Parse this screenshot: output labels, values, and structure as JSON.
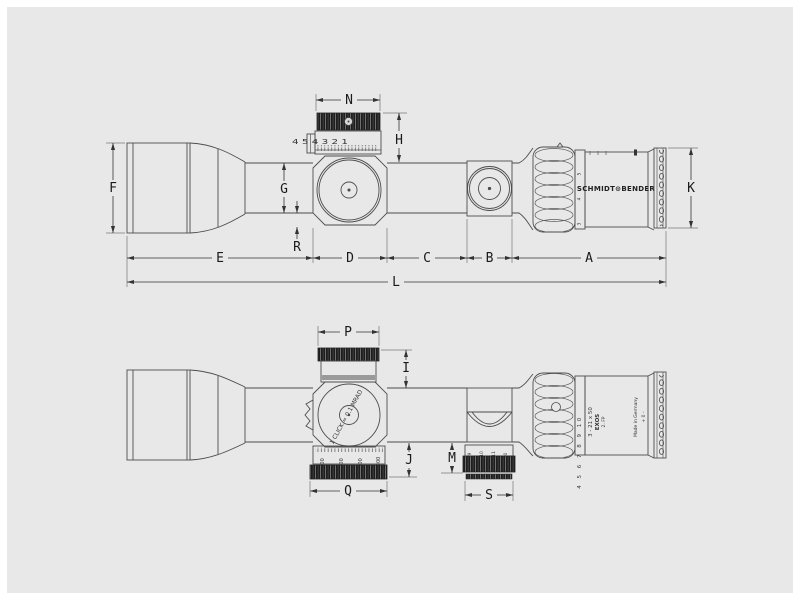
{
  "background_color": "#e8e8e8",
  "line_color": "#4d4d4d",
  "brand_text": "SCHMIDT⊙BENDER",
  "side_view": {
    "dims": {
      "N": "N",
      "H": "H",
      "F": "F",
      "G": "G",
      "R": "R",
      "K": "K",
      "E": "E",
      "D": "D",
      "C": "C",
      "B": "B",
      "A": "A",
      "L": "L"
    },
    "elevation_scale": "4 5 4 3 2 1",
    "zoom_visible": [
      "3",
      "4",
      "5"
    ]
  },
  "plan_view": {
    "dims": {
      "P": "P",
      "I": "I",
      "J": "J",
      "M": "M",
      "Q": "Q",
      "S": "S"
    },
    "click_text": "1 CLICK = 0.1 MRAD",
    "parallax_scale": [
      "300",
      "500",
      "800",
      "1000"
    ],
    "focus_scale": [
      "9",
      "10",
      "11",
      "0"
    ],
    "zoom_scale": "4 5 6 7 8 9 10",
    "model": "3 - 21 x 50",
    "series": "EXOS",
    "focal_plane": "2. FP",
    "made_in": "Made in Germany",
    "illumination": "+ 0 -"
  }
}
